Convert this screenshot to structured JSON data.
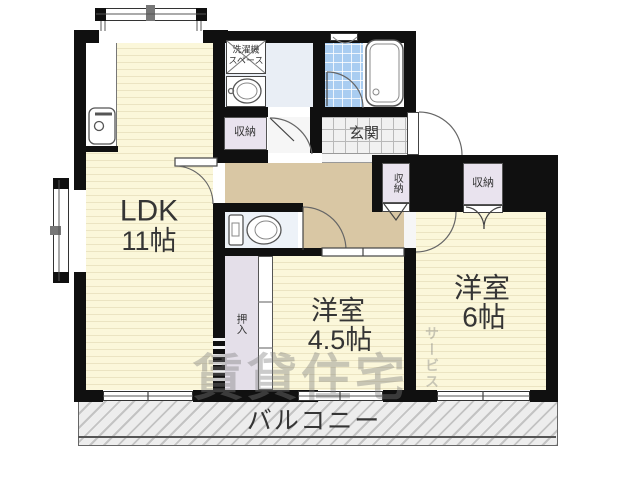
{
  "rooms": {
    "ldk": {
      "line1": "LDK",
      "line2": "11帖"
    },
    "western_45": {
      "line1": "洋室",
      "line2": "4.5帖"
    },
    "western_6": {
      "line1": "洋室",
      "line2": "6帖"
    },
    "balcony": {
      "label": "バルコニー"
    },
    "genkan": {
      "label": "玄関"
    }
  },
  "fixtures": {
    "laundry": {
      "line1": "洗濯機",
      "line2": "スペース"
    },
    "storage_washroom": {
      "label": "収納"
    },
    "storage_hall": {
      "label": "収納"
    },
    "storage_west6": {
      "label": "収納"
    },
    "oshiire": {
      "label": "押入"
    }
  },
  "watermark": {
    "main": "賃貸住宅",
    "sub": "サービス"
  },
  "colors": {
    "room_floor": "#fbf7da",
    "hall_floor": "#d9c7a4",
    "bath_tile": "#a9cdf1",
    "storage": "#e9e3ee",
    "wall": "#101010"
  }
}
